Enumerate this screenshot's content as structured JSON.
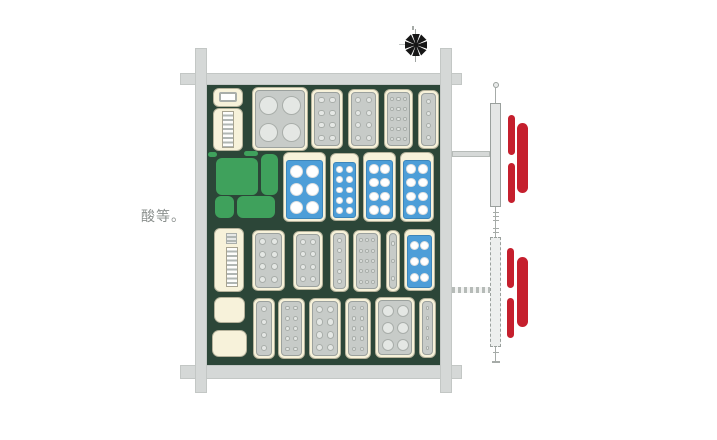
{
  "labels": {
    "room_note": "酸等。"
  },
  "colors": {
    "floor": "#2c4638",
    "wall": "#d5d8d7",
    "cream": "#f7f2da",
    "gray_panel": "#c7cbc8",
    "blue_panel": "#4d9ed8",
    "green_table": "#3fa15c",
    "red_radiator": "#c51f2d",
    "note_text": "#8b908e"
  },
  "walls": [
    {
      "name": "wall-top",
      "x": 180,
      "y": 73,
      "w": 282,
      "h": 12
    },
    {
      "name": "wall-bottom",
      "x": 180,
      "y": 365,
      "w": 282,
      "h": 14
    },
    {
      "name": "wall-left",
      "x": 195,
      "y": 48,
      "w": 12,
      "h": 345
    },
    {
      "name": "wall-right",
      "x": 440,
      "y": 48,
      "w": 12,
      "h": 345
    }
  ],
  "floor": {
    "name": "lab-floor",
    "x": 207,
    "y": 85,
    "w": 233,
    "h": 280
  },
  "fan": {
    "cx": 416,
    "cy": 45,
    "r": 11,
    "blades": 8,
    "vline": {
      "x": 415,
      "y1": 29,
      "y2": 62
    },
    "hline": {
      "x1": 399,
      "x2": 414,
      "y": 44
    },
    "tick": {
      "x": 412,
      "y": 26,
      "h": 4
    }
  },
  "units": [
    {
      "name": "cabinet-small",
      "style": "cream",
      "x": 213,
      "y": 88,
      "w": 30,
      "h": 19,
      "inner": "white-rect"
    },
    {
      "name": "ladder-bench",
      "style": "cream",
      "x": 213,
      "y": 108,
      "w": 30,
      "h": 43,
      "inner": "ladder"
    },
    {
      "name": "stove-4-burner",
      "style": "gray",
      "x": 252,
      "y": 87,
      "w": 56,
      "h": 64,
      "dots": {
        "cols": 2,
        "rows": 2,
        "r": 9.5
      }
    },
    {
      "name": "gray-workbench",
      "style": "gray",
      "x": 311,
      "y": 89,
      "w": 32,
      "h": 60,
      "dots": {
        "cols": 2,
        "rows": 4,
        "r": 3.2
      }
    },
    {
      "name": "gray-workbench",
      "style": "gray",
      "x": 348,
      "y": 89,
      "w": 31,
      "h": 60,
      "dots": {
        "cols": 2,
        "rows": 4,
        "r": 3.2
      }
    },
    {
      "name": "gray-workbench",
      "style": "gray",
      "x": 384,
      "y": 89,
      "w": 29,
      "h": 60,
      "dots": {
        "cols": 3,
        "rows": 5,
        "r": 2.2
      }
    },
    {
      "name": "gray-workbench-narrow",
      "style": "gray",
      "x": 418,
      "y": 90,
      "w": 21,
      "h": 59,
      "dots": {
        "cols": 1,
        "rows": 4,
        "r": 2.6
      }
    },
    {
      "name": "green-ledge",
      "style": "green",
      "x": 208,
      "y": 152,
      "w": 9,
      "h": 5
    },
    {
      "name": "green-ledge",
      "style": "green",
      "x": 244,
      "y": 151,
      "w": 14,
      "h": 5
    },
    {
      "name": "green-table",
      "style": "green",
      "x": 216,
      "y": 158,
      "w": 42,
      "h": 37
    },
    {
      "name": "green-table",
      "style": "green",
      "x": 261,
      "y": 154,
      "w": 17,
      "h": 41
    },
    {
      "name": "green-table",
      "style": "green",
      "x": 215,
      "y": 196,
      "w": 19,
      "h": 22
    },
    {
      "name": "green-table",
      "style": "green",
      "x": 237,
      "y": 196,
      "w": 38,
      "h": 22
    },
    {
      "name": "blue-fume-bench",
      "style": "blue",
      "x": 283,
      "y": 152,
      "w": 43,
      "h": 70,
      "pt": 8,
      "dots": {
        "cols": 2,
        "rows": 3,
        "r": 6.5
      }
    },
    {
      "name": "blue-fume-bench",
      "style": "blue",
      "x": 330,
      "y": 153,
      "w": 29,
      "h": 68,
      "pt": 9,
      "dots": {
        "cols": 2,
        "rows": 5,
        "r": 3.4
      }
    },
    {
      "name": "blue-fume-bench",
      "style": "blue",
      "x": 363,
      "y": 152,
      "w": 33,
      "h": 70,
      "pt": 8,
      "dots": {
        "cols": 2,
        "rows": 4,
        "r": 4.8
      }
    },
    {
      "name": "blue-fume-bench",
      "style": "blue",
      "x": 400,
      "y": 152,
      "w": 34,
      "h": 70,
      "pt": 8,
      "dots": {
        "cols": 2,
        "rows": 4,
        "r": 4.8
      }
    },
    {
      "name": "ladder-bench",
      "style": "cream",
      "x": 214,
      "y": 228,
      "w": 30,
      "h": 64,
      "inner": "stripe-ladder"
    },
    {
      "name": "gray-workbench",
      "style": "gray",
      "x": 252,
      "y": 230,
      "w": 33,
      "h": 61,
      "dots": {
        "cols": 2,
        "rows": 4,
        "r": 3.4
      }
    },
    {
      "name": "gray-workbench",
      "style": "gray",
      "x": 293,
      "y": 231,
      "w": 30,
      "h": 59,
      "dots": {
        "cols": 2,
        "rows": 4,
        "r": 3.0
      }
    },
    {
      "name": "gray-workbench-narrow",
      "style": "gray",
      "x": 330,
      "y": 230,
      "w": 19,
      "h": 62,
      "dots": {
        "cols": 1,
        "rows": 5,
        "r": 2.4
      }
    },
    {
      "name": "gray-workbench",
      "style": "gray",
      "x": 353,
      "y": 230,
      "w": 28,
      "h": 62,
      "dots": {
        "cols": 3,
        "rows": 5,
        "r": 2.0
      }
    },
    {
      "name": "gray-workbench-narrow",
      "style": "gray",
      "x": 386,
      "y": 230,
      "w": 14,
      "h": 62,
      "dots": {
        "cols": 1,
        "rows": 3,
        "r": 2.4
      }
    },
    {
      "name": "blue-fume-bench",
      "style": "blue",
      "x": 404,
      "y": 229,
      "w": 31,
      "h": 62,
      "pt": 6,
      "dots": {
        "cols": 2,
        "rows": 3,
        "r": 4.6
      }
    },
    {
      "name": "plain-cabinet",
      "style": "plain",
      "x": 214,
      "y": 297,
      "w": 31,
      "h": 26
    },
    {
      "name": "plain-cabinet",
      "style": "plain",
      "x": 212,
      "y": 330,
      "w": 35,
      "h": 27
    },
    {
      "name": "gray-workbench-narrow",
      "style": "gray",
      "x": 253,
      "y": 298,
      "w": 22,
      "h": 61,
      "dots": {
        "cols": 1,
        "rows": 4,
        "r": 3.0
      }
    },
    {
      "name": "gray-workbench",
      "style": "gray",
      "x": 278,
      "y": 298,
      "w": 27,
      "h": 61,
      "dots": {
        "cols": 2,
        "rows": 5,
        "r": 2.4
      }
    },
    {
      "name": "gray-workbench",
      "style": "gray",
      "x": 309,
      "y": 298,
      "w": 32,
      "h": 61,
      "dots": {
        "cols": 2,
        "rows": 4,
        "r": 3.8
      }
    },
    {
      "name": "gray-workbench",
      "style": "gray",
      "x": 345,
      "y": 298,
      "w": 26,
      "h": 61,
      "dots": {
        "cols": 2,
        "rows": 5,
        "r": 2.4
      }
    },
    {
      "name": "gray-workbench-wide",
      "style": "gray",
      "x": 375,
      "y": 297,
      "w": 40,
      "h": 61,
      "dots": {
        "cols": 2,
        "rows": 3,
        "r": 6.0
      }
    },
    {
      "name": "gray-workbench-narrow",
      "style": "gray",
      "x": 419,
      "y": 298,
      "w": 17,
      "h": 60,
      "dots": {
        "cols": 1,
        "rows": 5,
        "r": 1.8
      }
    }
  ],
  "service_columns": [
    {
      "name": "service-column-top",
      "knob": {
        "x": 493,
        "y": 82,
        "d": 6
      },
      "stems": [
        {
          "x": 495,
          "y": 88,
          "h": 15,
          "ticks": []
        },
        {
          "x": 495,
          "y": 207,
          "h": 20,
          "ticks": [
            212,
            216,
            220
          ]
        }
      ],
      "column": {
        "x": 490,
        "y": 103,
        "w": 11,
        "h": 104,
        "dashed": false
      },
      "connector": {
        "x": 452,
        "y": 151,
        "w": 38,
        "h": 6,
        "dashed": false
      },
      "red_bars": [
        {
          "x": 508,
          "y": 115,
          "w": 7,
          "h": 40
        },
        {
          "x": 517,
          "y": 123,
          "w": 11,
          "h": 70
        },
        {
          "x": 508,
          "y": 163,
          "w": 7,
          "h": 40
        }
      ]
    },
    {
      "name": "service-column-bottom",
      "stems": [
        {
          "x": 495,
          "y": 225,
          "h": 12,
          "ticks": [
            228,
            232
          ]
        },
        {
          "x": 495,
          "y": 347,
          "h": 16,
          "ticks": [
            352
          ],
          "tend": 361
        }
      ],
      "column": {
        "x": 490,
        "y": 237,
        "w": 11,
        "h": 110,
        "dashed": true
      },
      "connector": {
        "x": 452,
        "y": 287,
        "w": 38,
        "h": 6,
        "dashed": true
      },
      "red_bars": [
        {
          "x": 507,
          "y": 248,
          "w": 7,
          "h": 40
        },
        {
          "x": 517,
          "y": 257,
          "w": 11,
          "h": 70
        },
        {
          "x": 507,
          "y": 298,
          "w": 7,
          "h": 40
        }
      ]
    }
  ],
  "note_position": {
    "x": 141,
    "y": 206
  }
}
